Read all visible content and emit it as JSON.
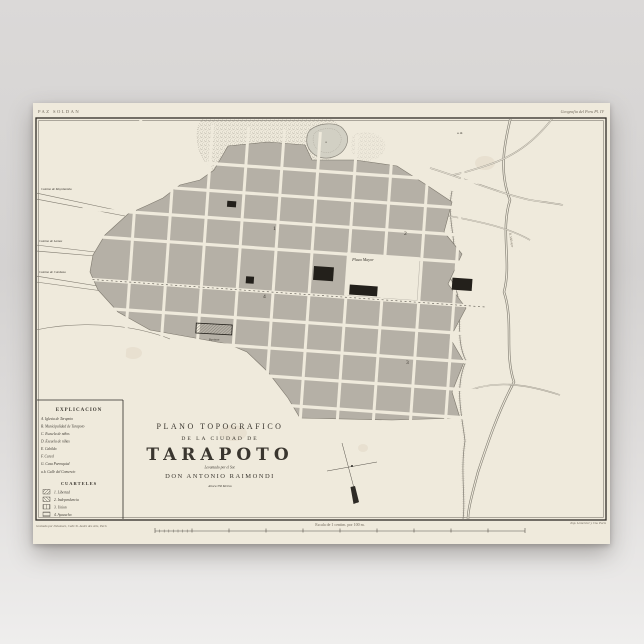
{
  "poster": {
    "series_label": "PAZ SOLDAN",
    "plate_label": "Geografia del Peru Pl. IV",
    "imprint_left": "Grabado por Delamare, Calle St. Andre des Arts, Paris",
    "imprint_right": "Imp. Lemercier y Cia. Paris",
    "colors": {
      "paper": "#efeadc",
      "blocks": "#b5b0a6",
      "ink": "#3a362f",
      "water": "#d2d0c4"
    }
  },
  "title_block": {
    "line1": "PLANO TOPOGRAFICO",
    "line2": "DE LA CIUDAD DE",
    "city": "TARAPOTO",
    "byline1": "Levantado por el Sor.",
    "byline2": "DON ANTONIO RAIMONDI",
    "note": "Altura 356 Metros"
  },
  "legend": {
    "title": "EXPLICACION",
    "items": [
      "A. Iglesia de Tarapoto",
      "B. Municipalidad de Tarapoto",
      "C. Escuela de niños",
      "D. Escuela de niñas",
      "E. Cabildo",
      "F. Carcel",
      "G. Casa Parroquial"
    ],
    "street_note": "a.b. Calle del Comercio",
    "cuarteles_title": "CUARTELES",
    "cuarteles": [
      "1. Libertad",
      "2. Independencia",
      "3. Union",
      "4. Ayacucho"
    ]
  },
  "map": {
    "plaza_label": "Plaza Mayor",
    "panteon_label": "Panteon",
    "river_label": "R. Shilcayo",
    "pond_label": "a",
    "ne_note": "a. R.",
    "roads": [
      "Camino de Moyobamba",
      "Camino de Lamas",
      "Camino de Cumbasa"
    ],
    "districts": [
      "1",
      "2",
      "3",
      "4"
    ],
    "scale_caption": "Escala de 1 centim. por 100 m."
  }
}
